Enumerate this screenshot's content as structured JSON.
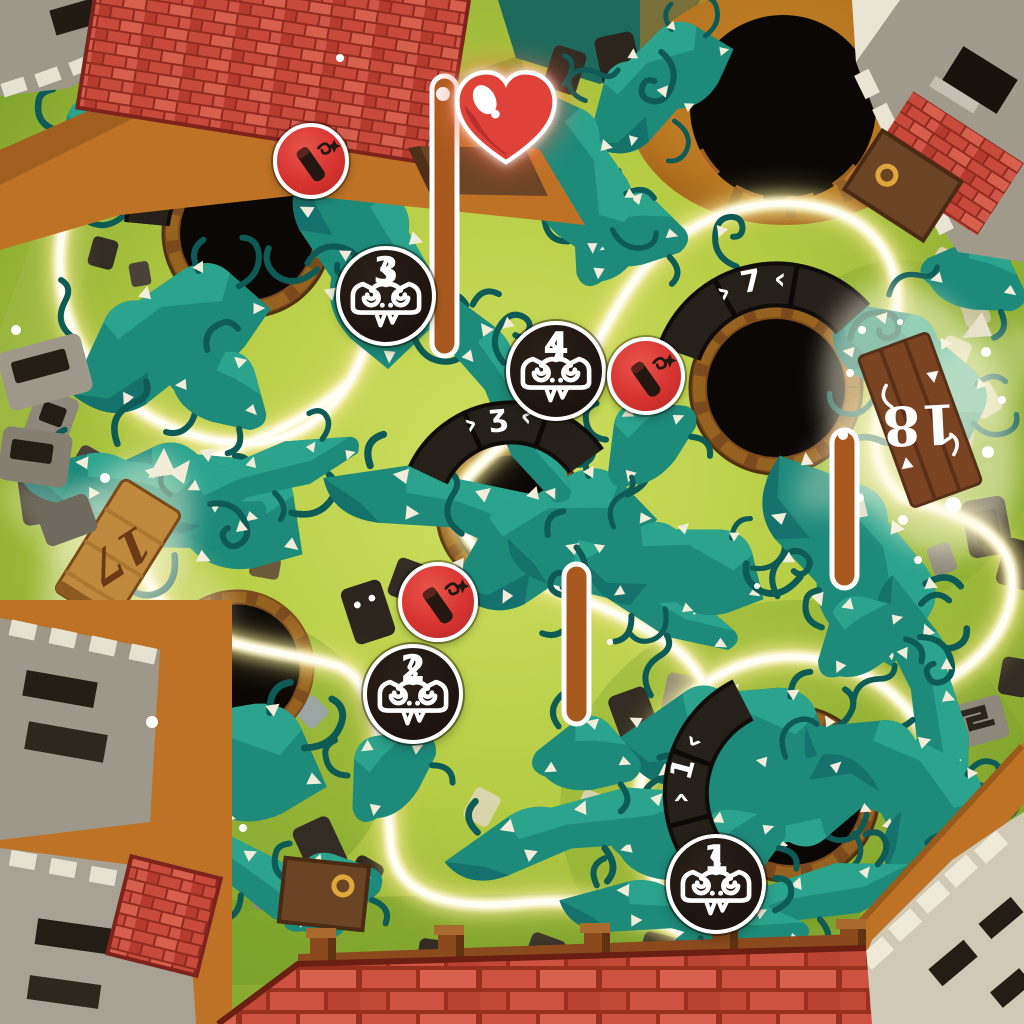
{
  "board": {
    "mole_tokens": [
      {
        "number": "1"
      },
      {
        "number": "2"
      },
      {
        "number": "3"
      },
      {
        "number": "4"
      }
    ],
    "bomb_token_count": 3,
    "heart_token_count": 1,
    "holes_count": 6,
    "sign_planks": [
      {
        "label": "17"
      },
      {
        "label": "18"
      }
    ],
    "rune_arcs": [
      {
        "glyphs": "›Σ‹"
      },
      {
        "glyphs": "›ʒ‹"
      },
      {
        "glyphs": "›7‹"
      },
      {
        "glyphs": "›1‹"
      }
    ],
    "icons": {
      "heart": "heart-icon",
      "bomb": "dynamite-icon",
      "mole": "mole-skull-icon"
    },
    "colors": {
      "field_light": "#cfe062",
      "field_dark": "#6f9a2b",
      "vine_teal": "#1d8a7a",
      "vine_dark": "#0e5a55",
      "glow_path": "#fff8d8",
      "hole_black": "#0a0705",
      "hole_rim_wood": "#7a4a1d",
      "dirt_orange": "#bd7226",
      "brick_red": "#c9473a",
      "token_black": "#1d1410",
      "bomb_red": "#d73431",
      "heart_red": "#df4238",
      "plank_light_wood": "#c08a3e",
      "plank_dark_wood": "#7a4423"
    }
  }
}
